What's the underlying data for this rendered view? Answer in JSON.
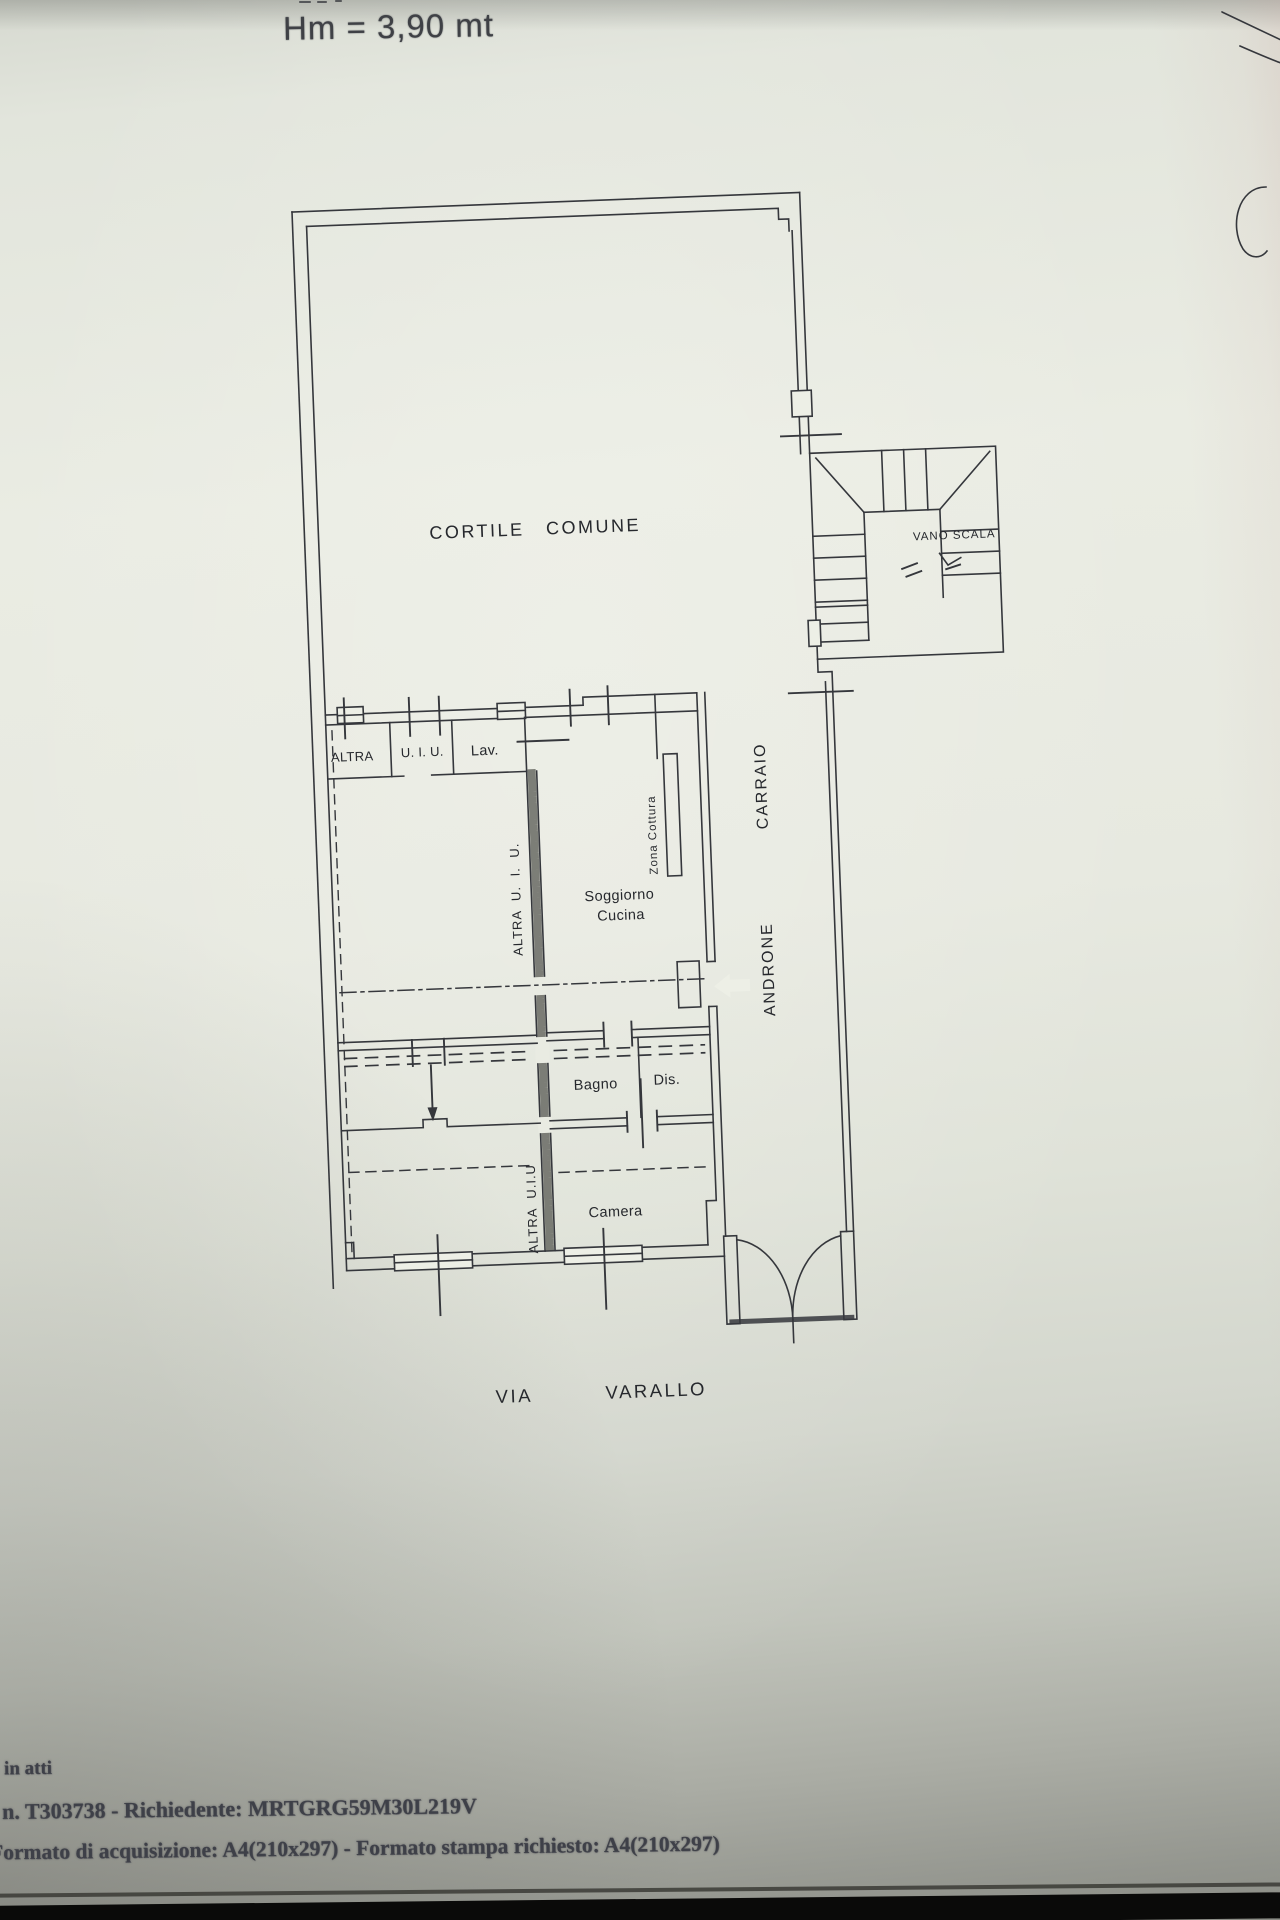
{
  "header": {
    "height_note": "Hm = 3,90 mt"
  },
  "plan": {
    "courtyard_label": "CORTILE COMUNE",
    "stairwell_label": "VANO SCALA",
    "hall_word1": "ANDRONE",
    "hall_word2": "CARRAIO",
    "top_row": {
      "altra": "ALTRA",
      "uiu": "U. I. U.",
      "lav": "Lav."
    },
    "unit_upper_label": "ALTRA U. I. U.",
    "living_line1": "Soggiorno",
    "living_line2": "Cucina",
    "cooking_label": "Zona Cottura",
    "bath_label": "Bagno",
    "closet_label": "Dis.",
    "bedroom_label": "Camera",
    "unit_lower_label": "ALTRA U.I.U",
    "street_word1": "VIA",
    "street_word2": "VARALLO"
  },
  "footer": {
    "note": "in atti",
    "request_line": "n. T303738 - Richiedente: MRTGRG59M30L219V",
    "format_line": "Formato di acquisizione: A4(210x297) - Formato stampa richiesto: A4(210x297)"
  },
  "colors": {
    "ink": "#35373c",
    "paper": "#e7e9e0",
    "footer_ink": "#3e4048",
    "bottom_bar": "#0a0a09"
  }
}
